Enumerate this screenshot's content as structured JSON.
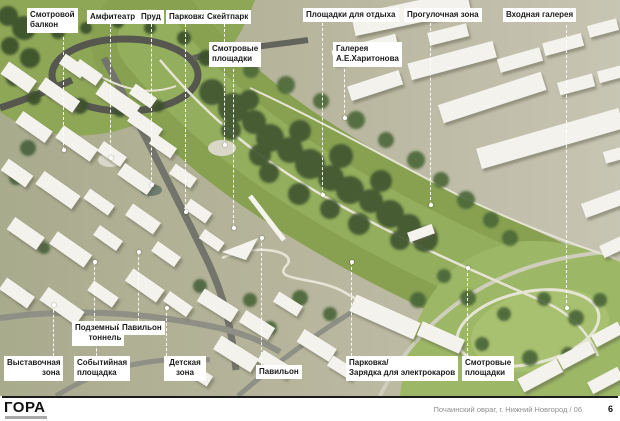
{
  "labels": [
    {
      "id": "smotrovoy-balkon",
      "text": "Смотровой\nбалкон"
    },
    {
      "id": "amfiteatr",
      "text": "Амфитеатр"
    },
    {
      "id": "prud",
      "text": "Пруд"
    },
    {
      "id": "parkovka-top",
      "text": "Парковка"
    },
    {
      "id": "skeytpark",
      "text": "Скейтпарк"
    },
    {
      "id": "smotrovye-ploshchadki-top",
      "text": "Смотровые\nплощадки"
    },
    {
      "id": "ploshchadki-dlya-otdykha",
      "text": "Площадки для отдыха"
    },
    {
      "id": "progulochnaya-zona",
      "text": "Прогулочная зона"
    },
    {
      "id": "vkhodnaya-galereya",
      "text": "Входная галерея"
    },
    {
      "id": "galereya-kharitonova",
      "text": "Галерея\nА.Е.Харитонова"
    },
    {
      "id": "podzemnyy-tonnel",
      "text": "Подземный\nтоннель"
    },
    {
      "id": "pavilon-left",
      "text": "Павильон"
    },
    {
      "id": "vystavochnaya-zona",
      "text": "Выставочная\nзона"
    },
    {
      "id": "sobytiynaya-ploshchadka",
      "text": "Событийная\nплощадка"
    },
    {
      "id": "detskaya-zona",
      "text": "Детская\nзона"
    },
    {
      "id": "pavilon-right",
      "text": "Павильон"
    },
    {
      "id": "parkovka-zaryadka",
      "text": "Парковка/\nЗарядка для электрокаров"
    },
    {
      "id": "smotrovye-ploshchadki-bottom",
      "text": "Смотровые\nплощадки"
    }
  ],
  "footer": {
    "logo": "ГОРА",
    "caption": "Почаинский овраг, г. Нижний Новгород / 06",
    "page": "6"
  },
  "colors": {
    "label_bg": "#ffffff",
    "label_text": "#1b1b1b",
    "ground_left": "#a9ab8d",
    "ground_right": "#c7c5b3",
    "park_green": "#87a151",
    "lawn_green": "#9cb765",
    "tree_green": "#3f5530",
    "road_dark": "#56574f",
    "road_gray": "#8e8f85",
    "path_light": "#e6e4d4",
    "building_white": "#f3f2ec",
    "footer_rule": "#1a1a1a",
    "caption_gray": "#8f8f8f"
  }
}
